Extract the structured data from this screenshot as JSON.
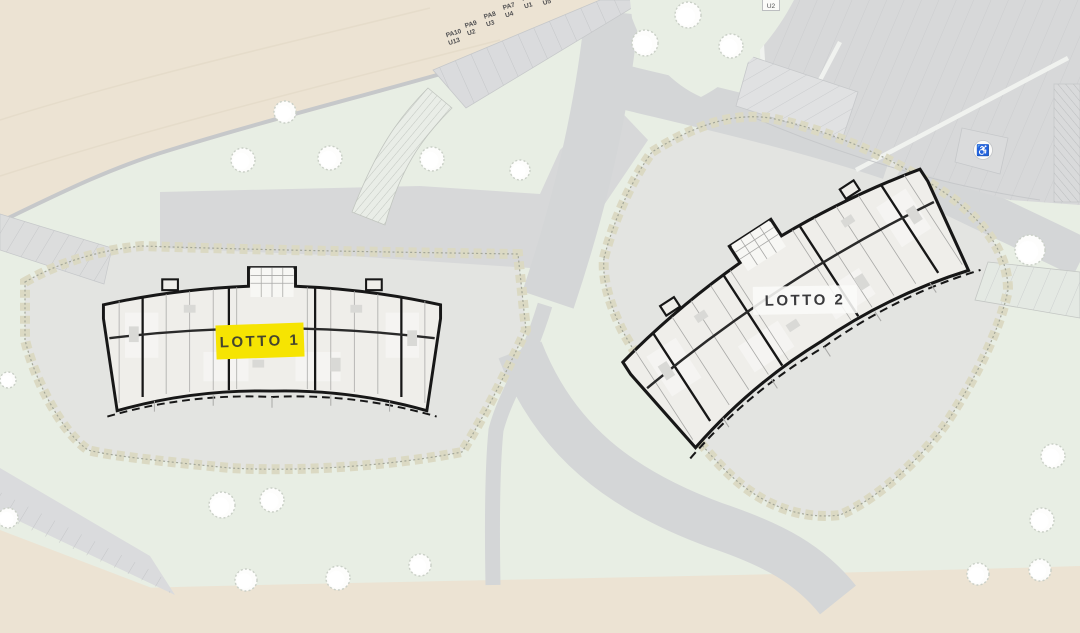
{
  "labels": {
    "lotto1": "LOTTO 1",
    "lotto2": "LOTTO 2"
  },
  "parking_stalls": [
    {
      "stall": "PA10",
      "unit": "U13"
    },
    {
      "stall": "PA9",
      "unit": "U2"
    },
    {
      "stall": "PA8",
      "unit": "U3"
    },
    {
      "stall": "PA7",
      "unit": "U4"
    },
    {
      "stall": "PA6",
      "unit": "U1"
    },
    {
      "stall": "",
      "unit": "U5"
    }
  ],
  "edge_labels": {
    "top_right_unit": "U2"
  },
  "icons": {
    "disabled_parking": "♿"
  },
  "colors": {
    "grass": "#e8eee4",
    "ground": "#ece3d3",
    "ground_line": "#e3dac8",
    "road": "#d4d6d7",
    "road_edge": "#c6c8ca",
    "parking": "#dadbdd",
    "plaza": "#d7d8d9",
    "parcel": "#e3e4e1",
    "hedge": "#dbd9c3",
    "hedge_dot": "#a3a698",
    "wall": "#171717",
    "building": "#efeeea",
    "interior_line": "#a9a9a7",
    "highlight": "#f6e402",
    "label_dark": "#45452e",
    "tree_stroke": "#c9cfc6",
    "white_gap": "#f0f2ef",
    "stall_line": "#c2c4c6"
  }
}
